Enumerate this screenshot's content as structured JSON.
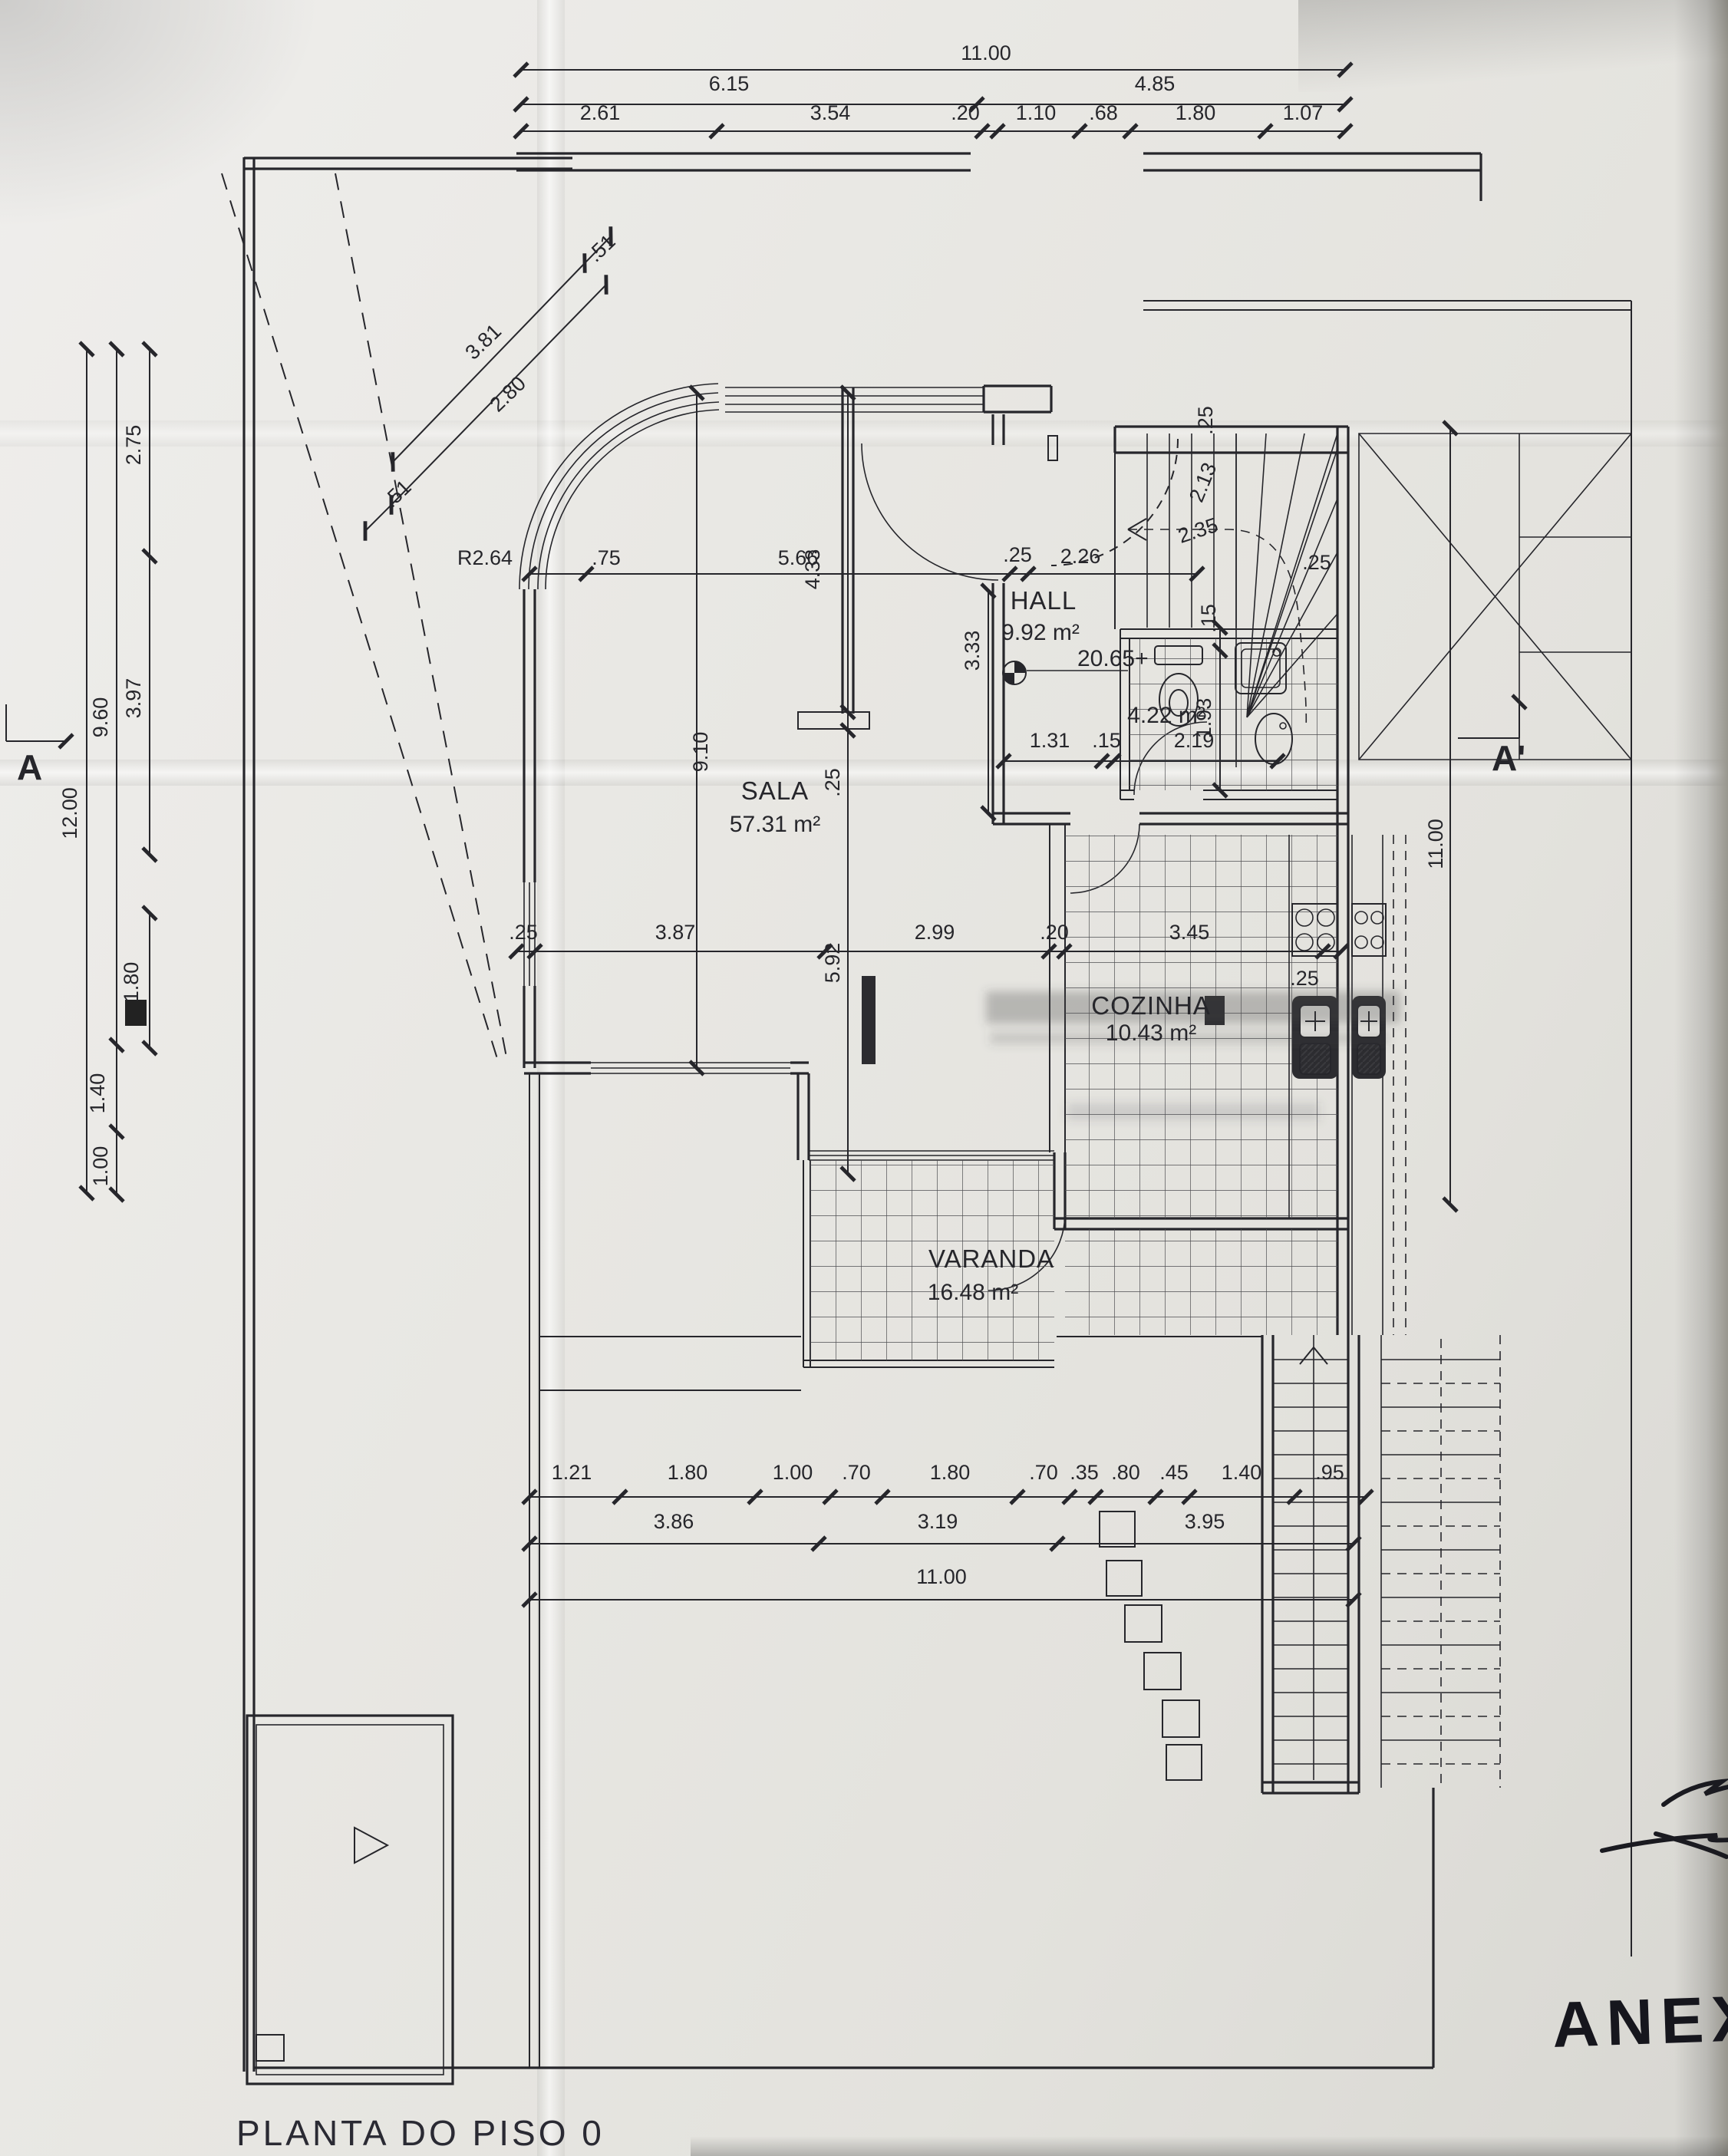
{
  "title": {
    "label": "PLANTA DO PISO 0"
  },
  "annotations": {
    "handwritten": "ANEXO"
  },
  "rooms": {
    "sala": {
      "name": "SALA",
      "area": "57.31 m²"
    },
    "hall": {
      "name": "HALL",
      "area": "9.92 m²"
    },
    "cozinha": {
      "name": "COZINHA",
      "area": "10.43 m²"
    },
    "varanda": {
      "name": "VARANDA",
      "area": "16.48 m²"
    },
    "bath": {
      "area": "4.22 m²"
    },
    "level": {
      "label": "20.65+"
    }
  },
  "section_markers": {
    "left": "A",
    "right": "A'"
  },
  "dims": {
    "top1": [
      "11.00"
    ],
    "top2": [
      "6.15",
      "4.85"
    ],
    "top3": [
      "2.61",
      "3.54",
      ".20",
      "1.10",
      ".68",
      "1.80",
      "1.07"
    ],
    "left_outer": [
      "12.00"
    ],
    "left_mid": [
      "9.60",
      "1.40",
      "1.00"
    ],
    "left_inner": [
      "2.75",
      "3.97",
      "1.80"
    ],
    "diag": [
      ".51",
      "3.81",
      "2.80",
      ".51"
    ],
    "row_upper": [
      "R2.64",
      ".75",
      "5.66",
      ".25",
      "2.26"
    ],
    "vert_labels": [
      "4.33",
      "3.33",
      "9.10",
      ".25",
      "5.92"
    ],
    "stair": [
      ".25",
      "2.13",
      "2.35",
      ".15",
      ".25"
    ],
    "bath_row": [
      "1.31",
      ".15",
      "2.19"
    ],
    "bath_vert": [
      "1.93"
    ],
    "mid_row": [
      ".25",
      "3.87",
      "2.99",
      ".20",
      "3.45",
      ".25"
    ],
    "right_vert": [
      "11.00"
    ],
    "bottom1": [
      "1.21",
      "1.80",
      "1.00",
      ".70",
      "1.80",
      ".70",
      ".35",
      ".80",
      ".45",
      "1.40",
      ".95"
    ],
    "bottom2": [
      "3.86",
      "3.19",
      "3.95"
    ],
    "bottom3": [
      "11.00"
    ]
  }
}
